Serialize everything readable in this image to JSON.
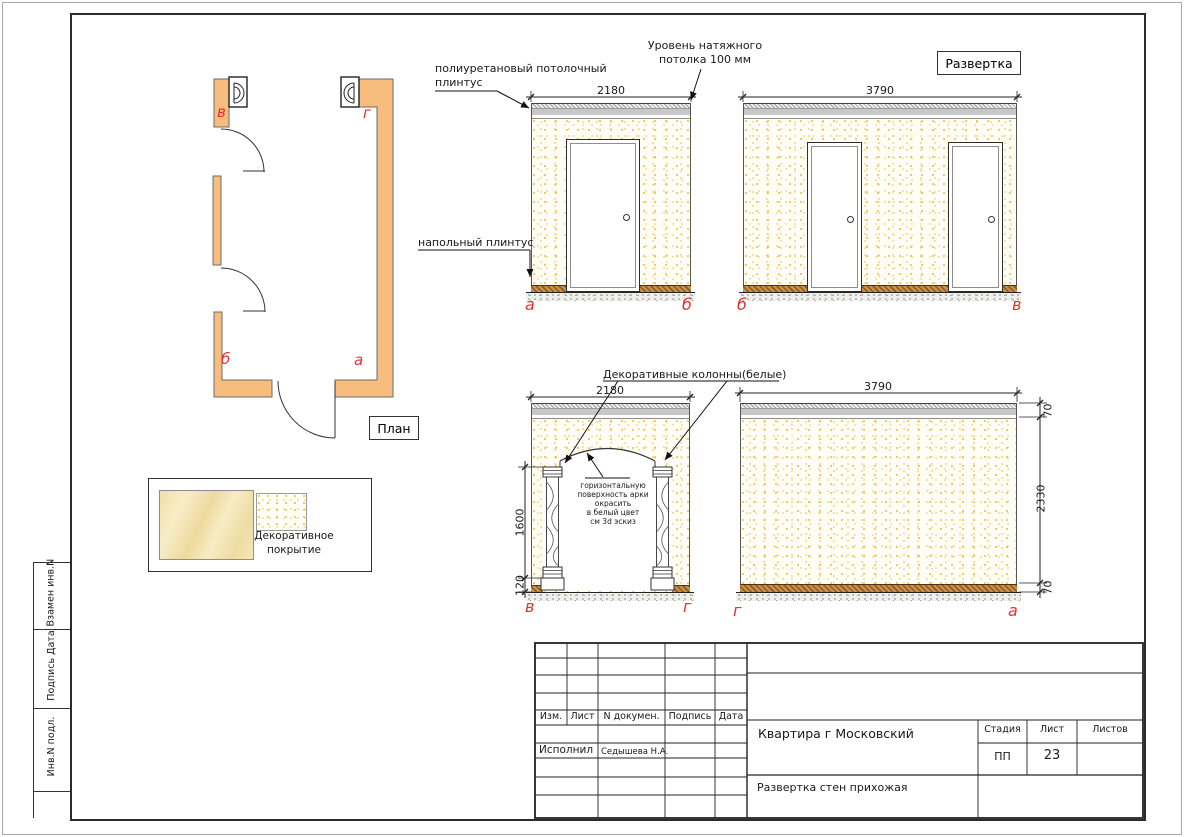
{
  "plan": {
    "label": "План",
    "corners": {
      "tl": "в",
      "tr": "г",
      "bl": "б",
      "br": "а"
    }
  },
  "annotations": {
    "ceiling_plinth": [
      "полиуретановый потолочный",
      "плинтус"
    ],
    "ceiling_level": [
      "Уровень натяжного",
      "потолка 100 мм"
    ],
    "floor_plinth": "напольный плинтус",
    "view_title": "Развертка",
    "columns": "Декоративные колонны(белые)",
    "arch_note": [
      "горизонтальную",
      "поверхность арки",
      "окрасить",
      "в белый цвет",
      "см 3d эскиз"
    ]
  },
  "dims": {
    "e1_w": "2180",
    "e2_w": "3790",
    "e3_w": "2180",
    "e4_w": "3790",
    "e3_h": "1600",
    "e3_plinth": "120",
    "e4_top": "70",
    "e4_mid": "2330",
    "e4_bottom": "70"
  },
  "labels": {
    "e1_left": "а",
    "e1_right": "б",
    "e2_left": "б",
    "e2_right": "в",
    "e3_left": "в",
    "e3_right": "г",
    "e4_left": "г",
    "e4_right": "а"
  },
  "legend": {
    "caption": [
      "Декоративное",
      "покрытие"
    ]
  },
  "title_block": {
    "cols": [
      "Изм.",
      "Лист",
      "N докумен.",
      "Подпись",
      "Дата"
    ],
    "executor_label": "Исполнил",
    "executor_name": "Седышева Н.А.",
    "project": "Квартира г Московский",
    "sheet_name": "Развертка стен прихожая",
    "stage_label": "Стадия",
    "sheet_label": "Лист",
    "sheets_label": "Листов",
    "stage": "ПП",
    "sheet_number": "23"
  },
  "side_stamp": [
    "Взамен инв.N",
    "Подпись Дата",
    "Инв.N подл."
  ],
  "colors": {
    "wall_fill": "#f7bd7f",
    "marker_red": "#e23333",
    "speckle": "#efb83e",
    "plinth_brown": "#c89048",
    "ceiling_gray": "#c7c7c7"
  }
}
